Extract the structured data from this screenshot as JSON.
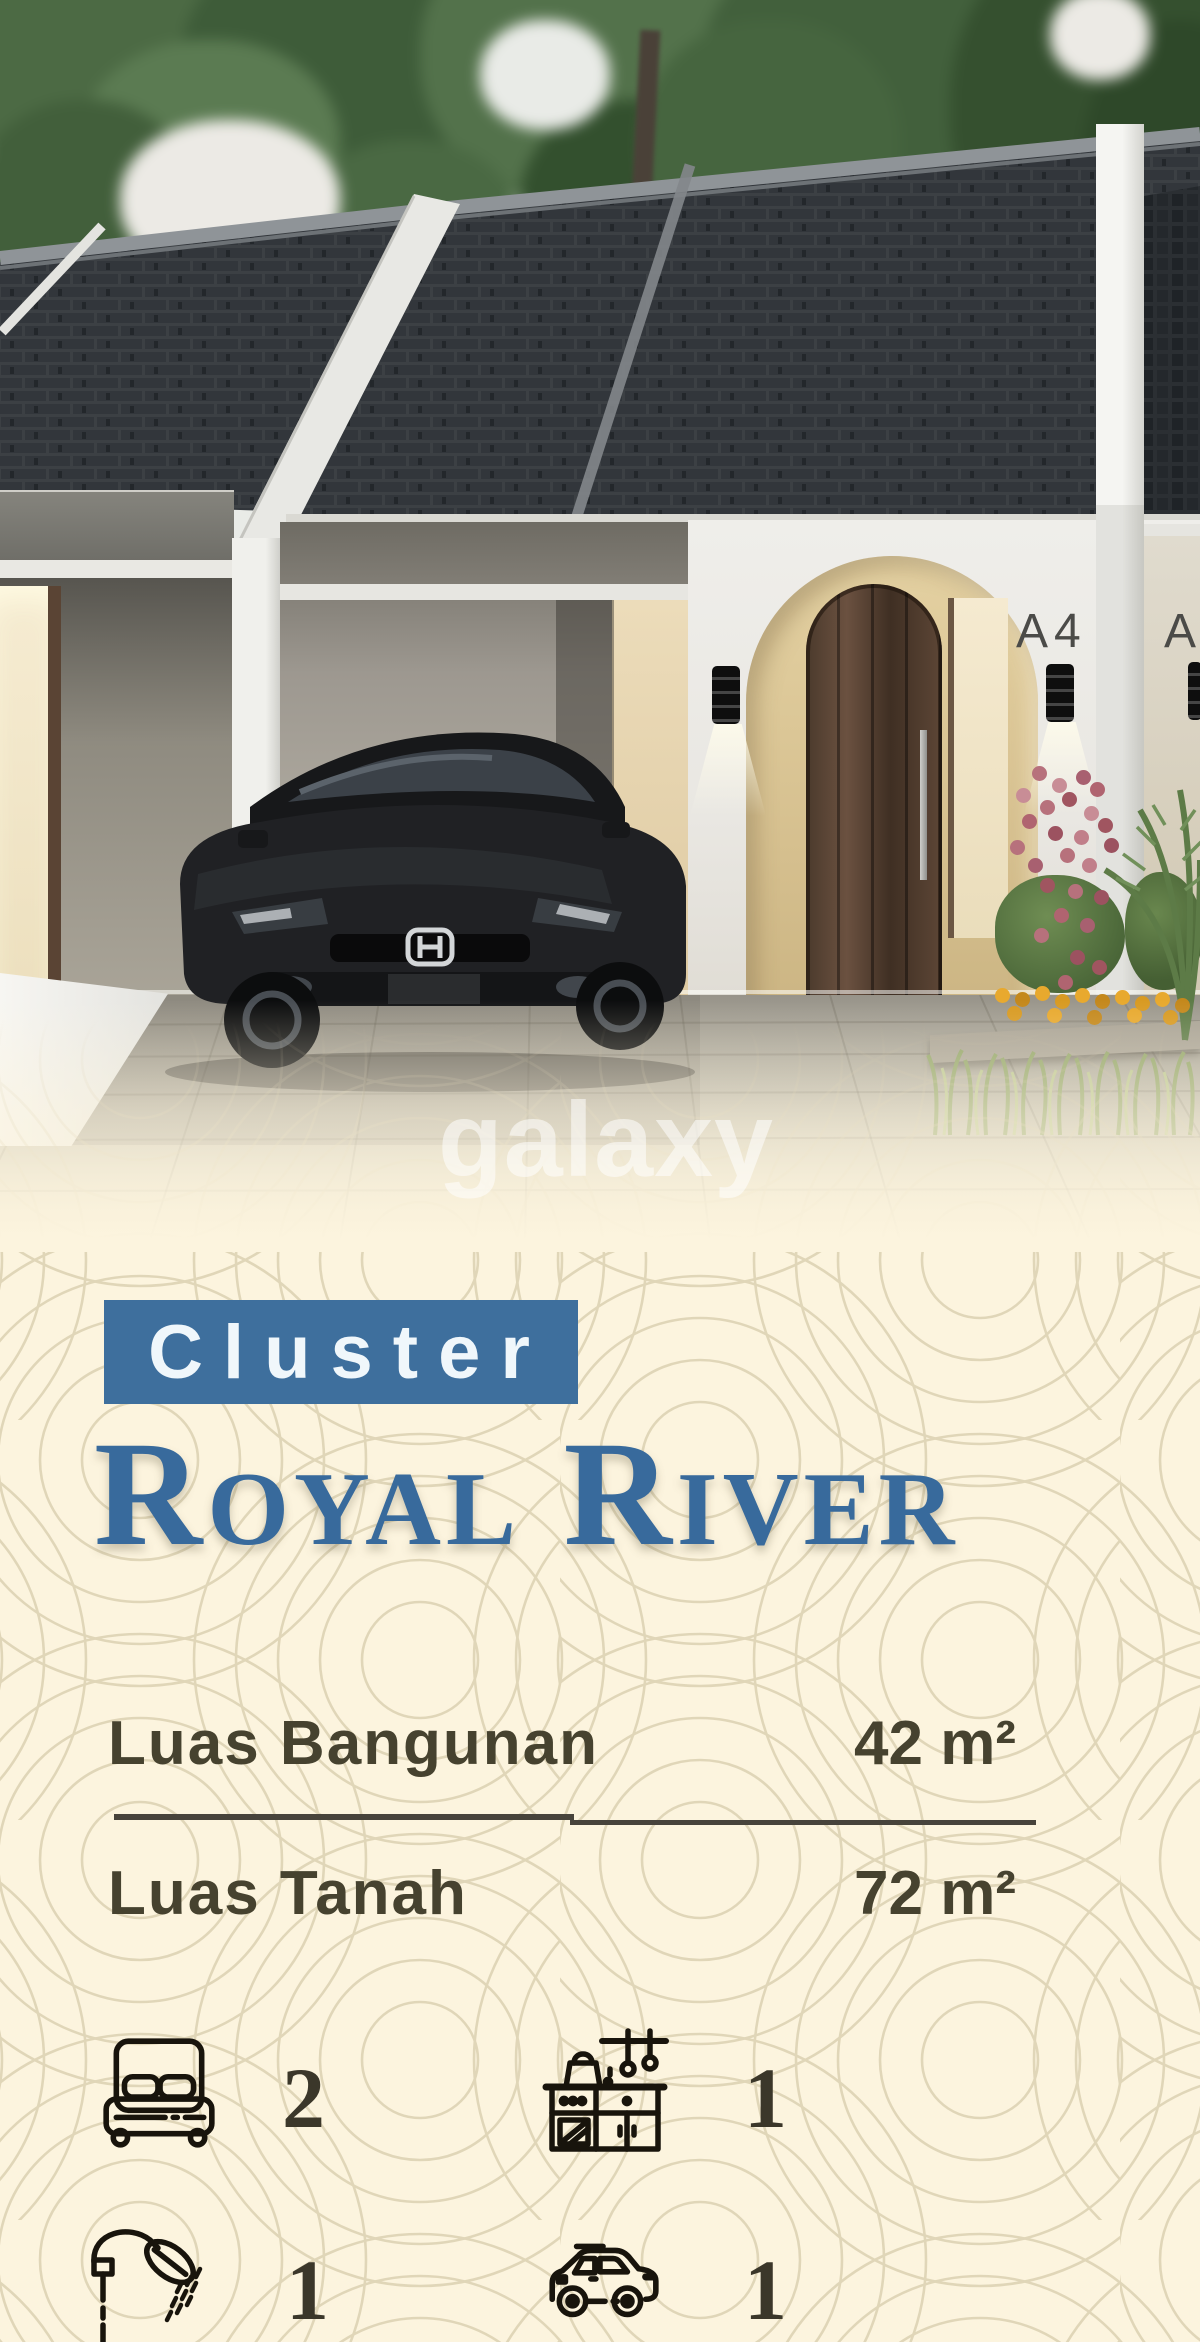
{
  "watermark": "galaxy",
  "photo": {
    "unit_label": "A4",
    "adjacent_unit_label": "A",
    "description": "render of one-storey cluster houses with black coupe parked in carport"
  },
  "badge": {
    "label": "Cluster"
  },
  "title": "Royal River",
  "specs": {
    "rows": [
      {
        "label": "Luas Bangunan",
        "value": "42 m²"
      },
      {
        "label": "Luas Tanah",
        "value": "72 m²"
      }
    ]
  },
  "features": [
    {
      "name": "bedroom",
      "count": "2"
    },
    {
      "name": "kitchen",
      "count": "1"
    },
    {
      "name": "bathroom",
      "count": "1"
    },
    {
      "name": "carport",
      "count": "1"
    }
  ],
  "colors": {
    "accent_blue": "#3e6f9d",
    "background_cream": "#fcf4de",
    "text_olive": "#46422f"
  }
}
